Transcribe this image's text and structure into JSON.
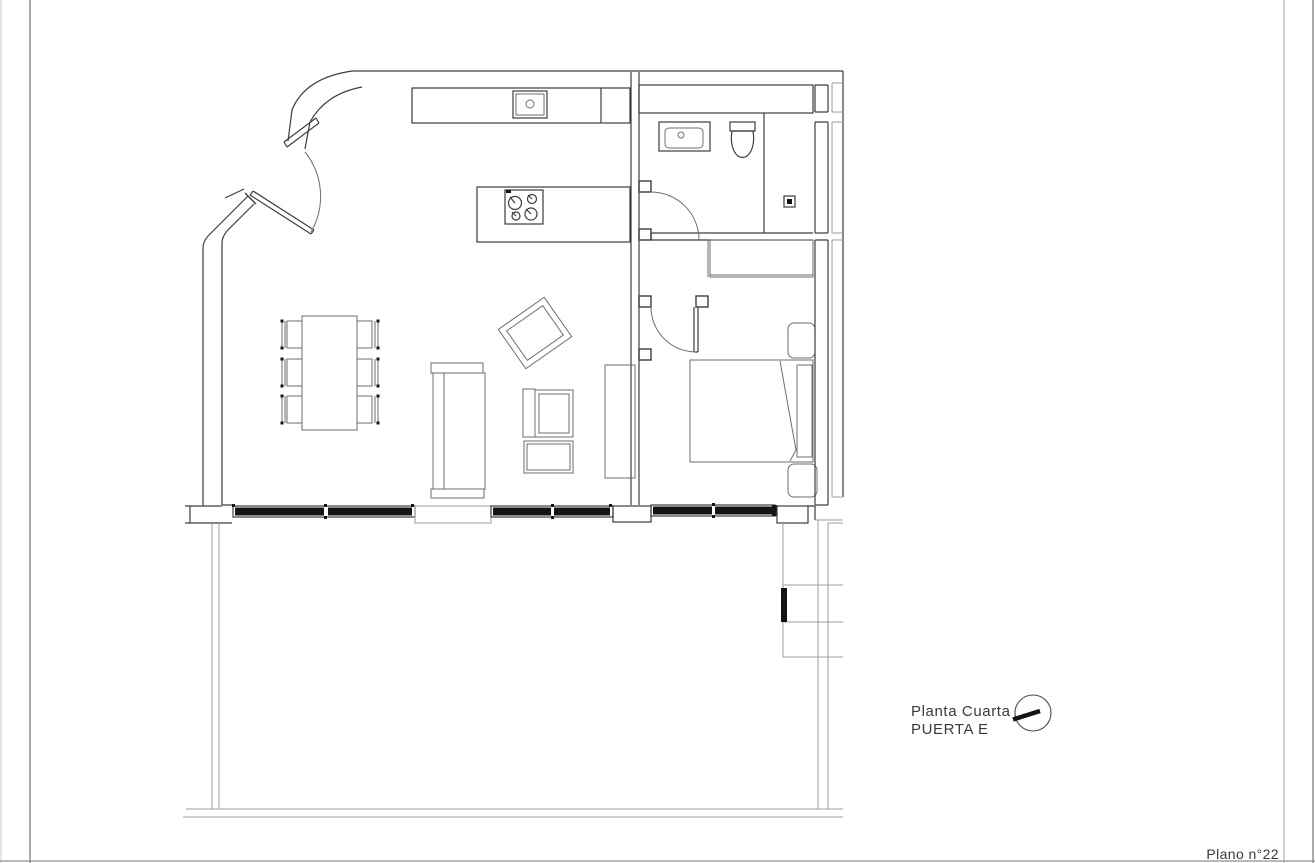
{
  "annotations": {
    "title_line1": "Planta Cuarta",
    "title_line2": "PUERTA E",
    "plan_number": "Plano n°22"
  },
  "colors": {
    "background": "#ffffff",
    "wall_line": "#3d3d3d",
    "furniture_line": "#6e6e6e",
    "light_line": "#9c9c9c",
    "glazing": "#141414",
    "text": "#3a3a3a"
  },
  "legend": {
    "orientation_marker": "circle-with-needle",
    "fixtures_drawn": [
      "kitchen-sink",
      "cooktop-4-burners",
      "washbasin",
      "toilet",
      "shower-drain",
      "wardrobe",
      "double-bed",
      "nightstand",
      "dining-table-6-chairs",
      "sofa",
      "armchair",
      "rotated-armchair",
      "side-desk",
      "window-glazing-bands",
      "terrace-parapet",
      "door-swing-arcs"
    ]
  }
}
